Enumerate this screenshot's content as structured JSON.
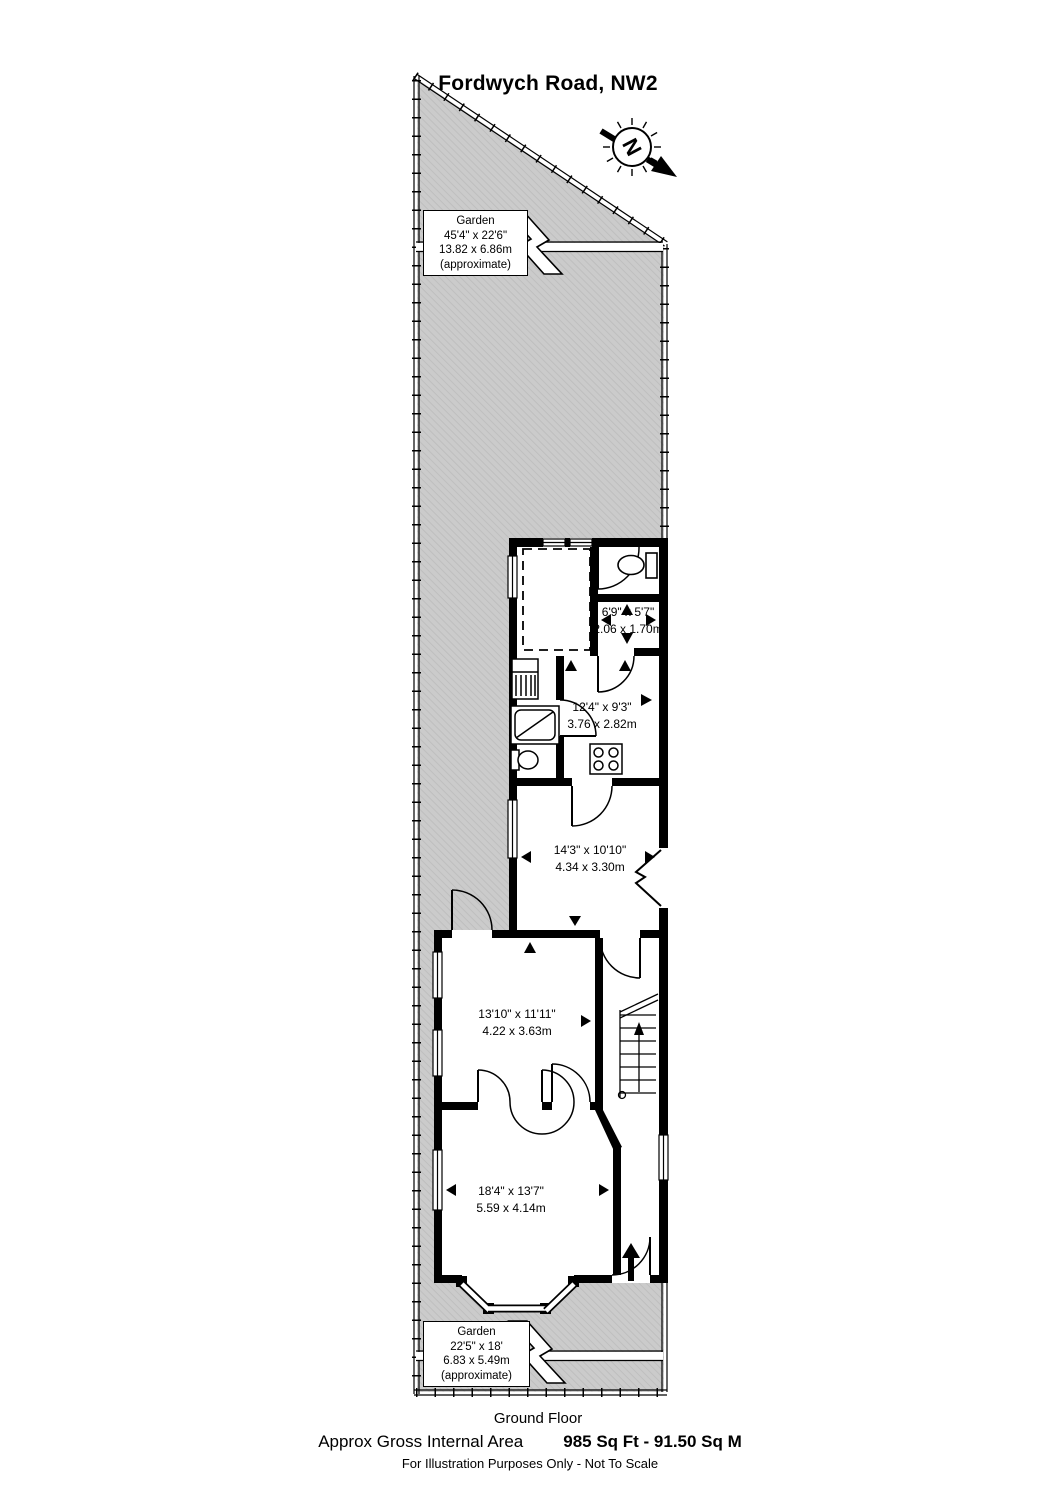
{
  "page": {
    "title": "Fordwych Road, NW2",
    "floor_label": "Ground Floor",
    "footer": {
      "area_label": "Approx Gross Internal Area",
      "area_value": "985 Sq Ft  -  91.50 Sq M",
      "disclaimer": "For Illustration Purposes Only - Not To Scale"
    },
    "compass": {
      "letter": "N"
    }
  },
  "gardens": {
    "rear": {
      "name": "Garden",
      "imperial": "45'4\" x 22'6\"",
      "metric": "13.82 x 6.86m",
      "note": "(approximate)"
    },
    "front": {
      "name": "Garden",
      "imperial": "22'5\" x 18'",
      "metric": "6.83 x 5.49m",
      "note": "(approximate)"
    }
  },
  "rooms": [
    {
      "id": "rear-room",
      "imperial": "6'9\" x 5'7\"",
      "metric": "2.06 x 1.70m"
    },
    {
      "id": "kitchen",
      "imperial": "12'4\" x 9'3\"",
      "metric": "3.76 x 2.82m"
    },
    {
      "id": "reception-rear",
      "imperial": "14'3\" x 10'10\"",
      "metric": "4.34 x 3.30m"
    },
    {
      "id": "reception-middle",
      "imperial": "13'10\" x 11'11\"",
      "metric": "4.22 x 3.63m"
    },
    {
      "id": "reception-front",
      "imperial": "18'4\" x 13'7\"",
      "metric": "5.59 x 4.14m"
    }
  ],
  "colors": {
    "garden_fill": "#cbcbcb",
    "wall": "#000000",
    "background": "#ffffff"
  }
}
